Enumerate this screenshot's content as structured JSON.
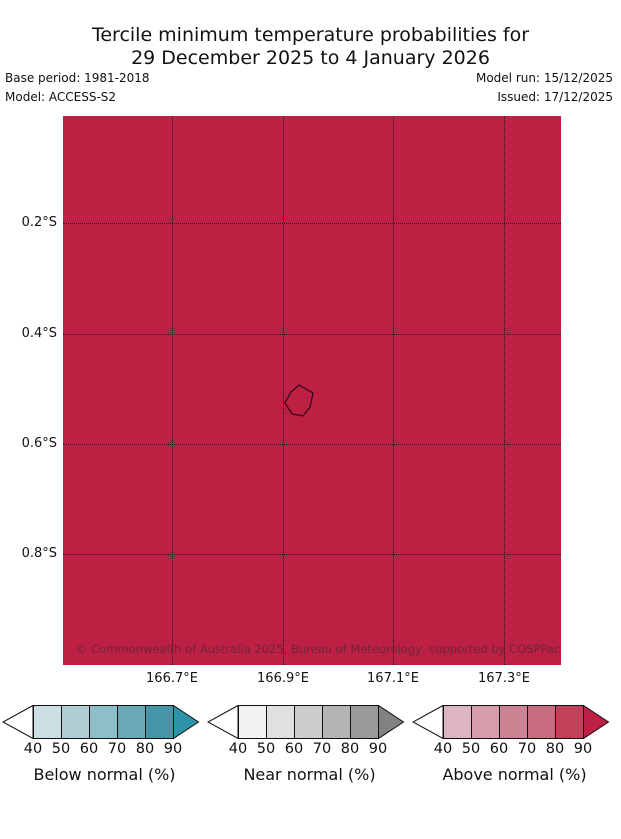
{
  "title": {
    "line1": "Tercile minimum temperature probabilities for",
    "line2": "29 December 2025 to 4 January 2026"
  },
  "header": {
    "base_period": "Base period: 1981-2018",
    "model": "Model: ACCESS-S2",
    "model_run": "Model run: 15/12/2025",
    "issued": "Issued: 17/12/2025"
  },
  "map": {
    "fill_color": "#BE2044",
    "grid_color": "#1a1a1a",
    "copyright": "© Commonwealth of Australia 2025, Bureau of Meteorology, supported by COSPPac",
    "x_ticks": [
      "166.7°E",
      "166.9°E",
      "167.1°E",
      "167.3°E"
    ],
    "y_ticks": [
      "0.2°S",
      "0.4°S",
      "0.6°S",
      "0.8°S"
    ]
  },
  "legends": [
    {
      "label": "Below normal (%)",
      "ticks": [
        "40",
        "50",
        "60",
        "70",
        "80",
        "90"
      ],
      "colors": [
        "#CBDEE2",
        "#AECED4",
        "#8EBEC8",
        "#69A9B7",
        "#4496A7"
      ],
      "arrow_color": "#2E93A8"
    },
    {
      "label": "Near normal (%)",
      "ticks": [
        "40",
        "50",
        "60",
        "70",
        "80",
        "90"
      ],
      "colors": [
        "#F2F2F2",
        "#E0E0E0",
        "#CDCDCD",
        "#B4B4B4",
        "#9A9A9A"
      ],
      "arrow_color": "#828282"
    },
    {
      "label": "Above normal (%)",
      "ticks": [
        "40",
        "50",
        "60",
        "70",
        "80",
        "90"
      ],
      "colors": [
        "#DCB5C0",
        "#D69EAB",
        "#CC8494",
        "#C66C7E",
        "#C04159"
      ],
      "arrow_color": "#BE2045"
    }
  ],
  "chart_data": {
    "type": "heatmap",
    "title": "Tercile minimum temperature probabilities for 29 December 2025 to 4 January 2026",
    "x_tick_labels": [
      "166.7°E",
      "166.9°E",
      "167.1°E",
      "167.3°E"
    ],
    "y_tick_labels": [
      "0.2°S",
      "0.4°S",
      "0.6°S",
      "0.8°S"
    ],
    "xlim": [
      "166.5°E",
      "167.4°E"
    ],
    "ylim": [
      "0.0°S",
      "1.0°S"
    ],
    "grid": "dotted",
    "values_note": "Entire map domain shaded in the darkest 'Above normal' class (probability > 90%)",
    "colorbars": [
      {
        "label": "Below normal (%)",
        "tick_values": [
          40,
          50,
          60,
          70,
          80,
          90
        ]
      },
      {
        "label": "Near normal (%)",
        "tick_values": [
          40,
          50,
          60,
          70,
          80,
          90
        ]
      },
      {
        "label": "Above normal (%)",
        "tick_values": [
          40,
          50,
          60,
          70,
          80,
          90
        ]
      }
    ]
  }
}
